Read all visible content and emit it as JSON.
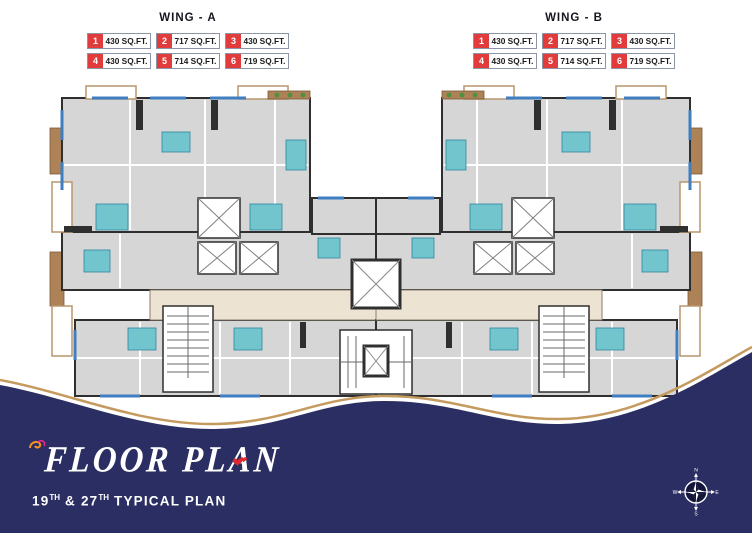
{
  "header": {
    "wings": [
      {
        "title": "WING - A",
        "units": [
          {
            "no": "1",
            "area": "430 SQ.FT."
          },
          {
            "no": "2",
            "area": "717 SQ.FT."
          },
          {
            "no": "3",
            "area": "430 SQ.FT."
          },
          {
            "no": "4",
            "area": "430 SQ.FT."
          },
          {
            "no": "5",
            "area": "714 SQ.FT."
          },
          {
            "no": "6",
            "area": "719 SQ.FT."
          }
        ]
      },
      {
        "title": "WING - B",
        "units": [
          {
            "no": "1",
            "area": "430 SQ.FT."
          },
          {
            "no": "2",
            "area": "717 SQ.FT."
          },
          {
            "no": "3",
            "area": "430 SQ.FT."
          },
          {
            "no": "4",
            "area": "430 SQ.FT."
          },
          {
            "no": "5",
            "area": "714 SQ.FT."
          },
          {
            "no": "6",
            "area": "719 SQ.FT."
          }
        ]
      }
    ]
  },
  "footer": {
    "title": "FLOOR PLAN",
    "subtitle": {
      "p1": "19",
      "sup1": "TH",
      "p2": " & 27",
      "sup2": "TH",
      "p3": " TYPICAL PLAN"
    }
  },
  "compass": {
    "north": "N",
    "east": "E",
    "south": "S",
    "west": "W"
  },
  "colors": {
    "navy": "#2b2e63",
    "gold": "#c59a5f",
    "legend_red": "#e23b3b",
    "heart_red": "#e0282e",
    "unit_gray": "#d6d6d6",
    "bath_teal": "#72c5cd",
    "wood_brown": "#ad8257",
    "corridor_beige": "#ece3d3",
    "window_blue": "#3f7ec0",
    "wall_dark": "#2f2f2f"
  }
}
